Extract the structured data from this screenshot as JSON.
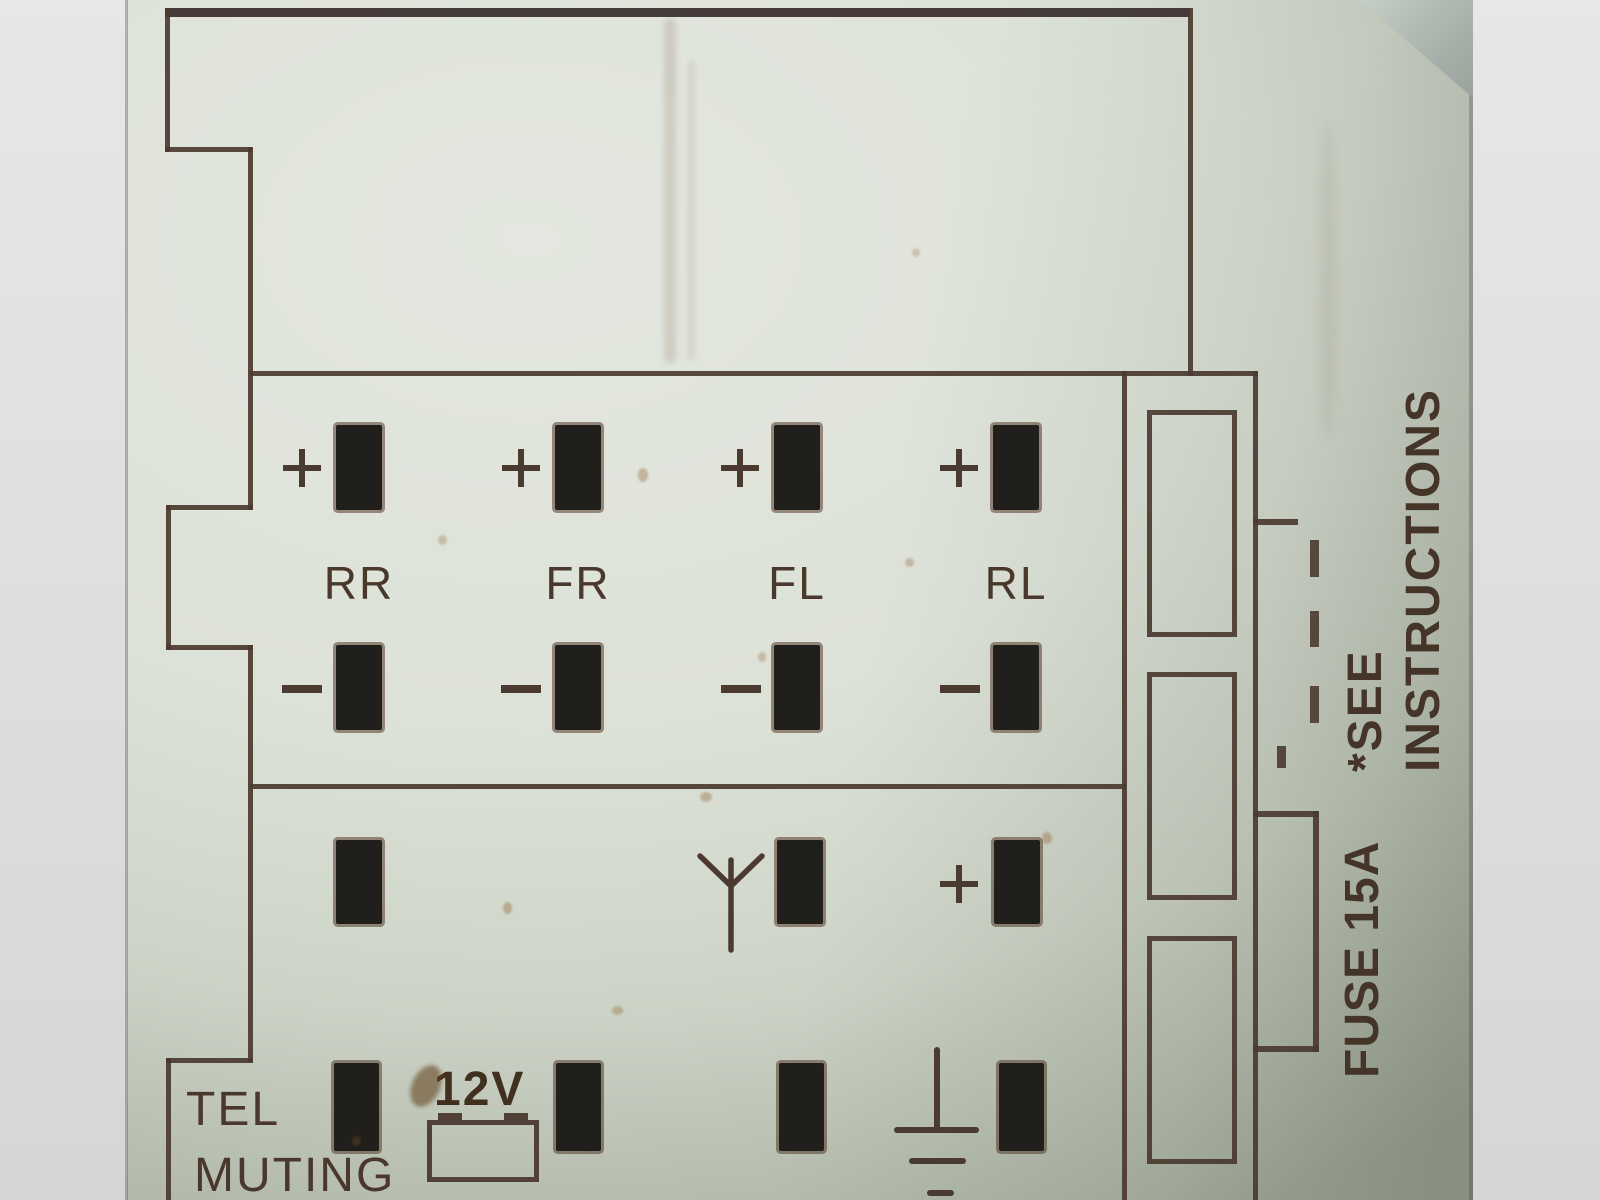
{
  "meta": {
    "description": "Photographed wiring-diagram label on a car radio: ISO connector pinout",
    "kind": "connector pinout sticker"
  },
  "colors": {
    "label_background": "#dde2d8",
    "diagram_line": "#4b3a2f",
    "pin_fill": "#201f1b",
    "text": "#4a382c",
    "backdrop_gray": "#dadada",
    "corner_shadow": "#9aa39d"
  },
  "speaker_section": {
    "polarity_positive": "+",
    "polarity_negative": "−",
    "channels": [
      {
        "label": "RR"
      },
      {
        "label": "FR"
      },
      {
        "label": "FL"
      },
      {
        "label": "RL"
      }
    ]
  },
  "bottom_section": {
    "tel_line1": "TEL",
    "tel_line2": "MUTING",
    "supply_label": "12V",
    "polarity_positive": "+",
    "icons": [
      "battery-icon",
      "antenna-icon",
      "ground-icon",
      "plus-icon"
    ]
  },
  "side_notes": {
    "see_line1": "*SEE",
    "see_line2": "INSTRUCTIONS",
    "fuse_label": "FUSE 15A"
  }
}
